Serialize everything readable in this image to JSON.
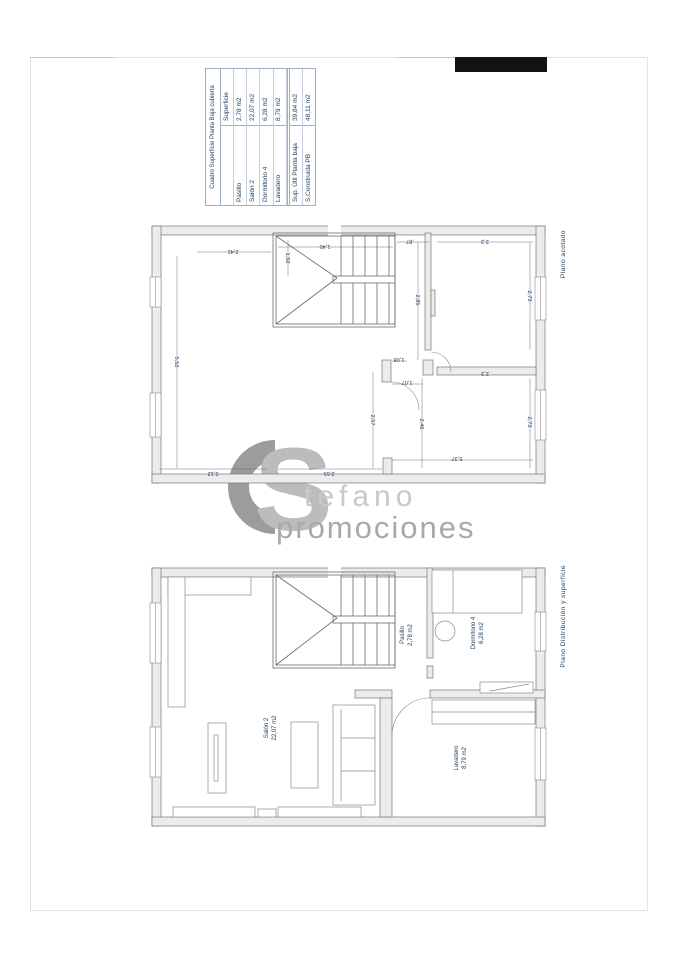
{
  "surface_table": {
    "title": "Cuadro Superficie Planta Baja cubierta",
    "col_header": "Superficie",
    "rows": [
      {
        "label": "Pasillo",
        "value": "2,78 m2"
      },
      {
        "label": "Salón 2",
        "value": "22,07 m2"
      },
      {
        "label": "Dormitorio 4",
        "value": "6,28 m2"
      },
      {
        "label": "Lavadero",
        "value": "8,79 m2"
      },
      {
        "label": "Sup. Útil Planta baja",
        "value": "39,84 m2"
      },
      {
        "label": "S.Construida PB",
        "value": "48,11 m2"
      }
    ]
  },
  "watermark": {
    "initial": "S",
    "name_rest": "tefano",
    "line2": "promociones"
  },
  "plan_top": {
    "caption": "Plano acotado",
    "dims": [
      "2,41",
      "1,45",
      ",87",
      "2,3",
      "5,52",
      "1,92",
      "2,85",
      "2,73",
      "1,08",
      "1,07",
      "2,3",
      "2,57",
      "2,46",
      "2,73",
      "2,12",
      "2,55",
      "5,37"
    ]
  },
  "plan_bottom": {
    "caption": "Plano Distribución y superficie",
    "rooms": [
      {
        "name": "Pasillo",
        "area": "2,78 m2"
      },
      {
        "name": "Dormitorio 4",
        "area": "6,28 m2"
      },
      {
        "name": "Salón 2",
        "area": "22,07 m2"
      },
      {
        "name": "Lavadero",
        "area": "8,79 m2"
      }
    ]
  },
  "colors": {
    "label_blue": "#1e3f63",
    "wall_fill": "#ececec",
    "line_gray": "#777777",
    "watermark_dark": "#9c9c9c",
    "watermark_mid": "#bcbcbc",
    "watermark_light": "#c9c9c9",
    "redaction_black": "#121212"
  }
}
